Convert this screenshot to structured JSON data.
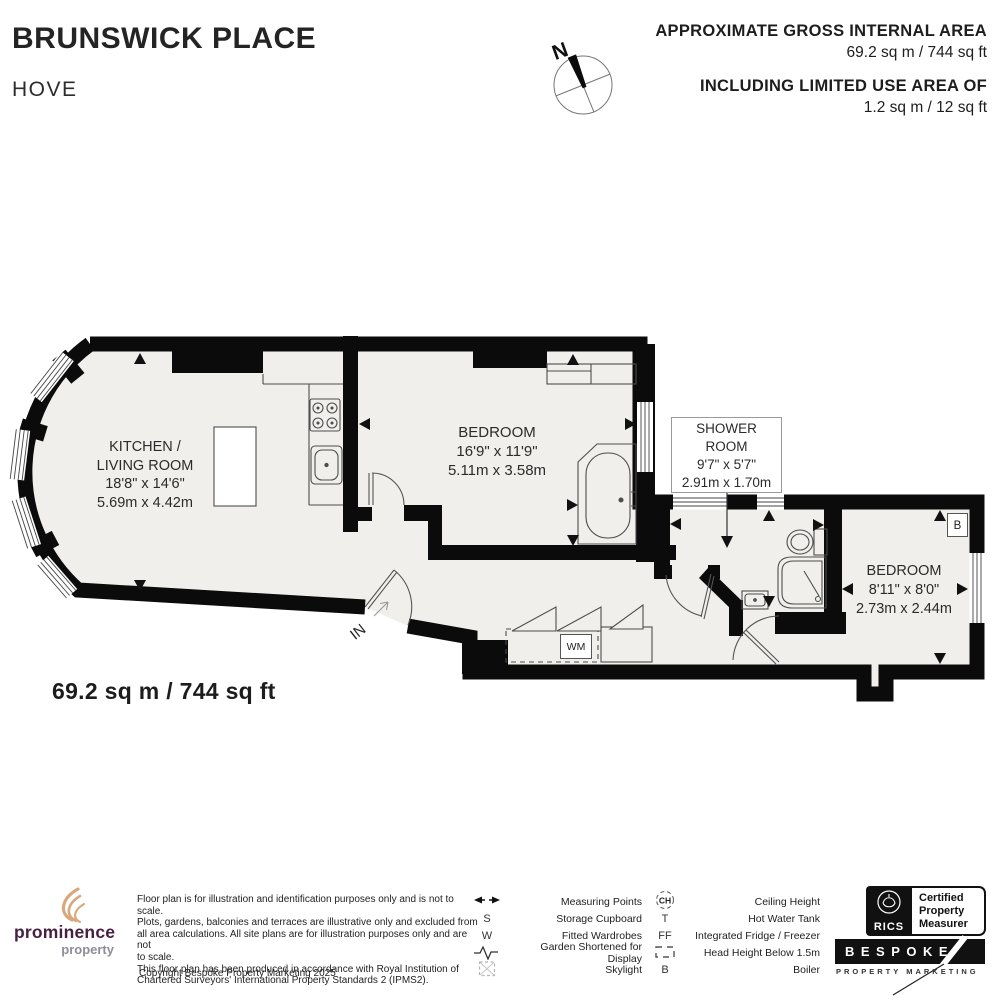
{
  "header": {
    "title": "BRUNSWICK PLACE",
    "subtitle": "HOVE",
    "gia_label": "APPROXIMATE GROSS INTERNAL AREA",
    "gia_value": "69.2 sq m / 744 sq ft",
    "limited_label": "INCLUDING LIMITED USE AREA OF",
    "limited_value": "1.2 sq m / 12 sq ft",
    "compass_north": "N"
  },
  "plan": {
    "total_area": "69.2 sq m / 744 sq ft",
    "in_label": "IN",
    "wm_label": "WM",
    "boiler_label": "B",
    "rooms": {
      "kitchen": {
        "line1": "KITCHEN /",
        "line2": "LIVING ROOM",
        "imperial": "18'8\" x 14'6\"",
        "metric": "5.69m x 4.42m"
      },
      "bedroom1": {
        "name": "BEDROOM",
        "imperial": "16'9\" x 11'9\"",
        "metric": "5.11m x 3.58m"
      },
      "shower": {
        "line1": "SHOWER",
        "line2": "ROOM",
        "imperial": "9'7\" x 5'7\"",
        "metric": "2.91m x 1.70m"
      },
      "bedroom2": {
        "name": "BEDROOM",
        "imperial": "8'11\" x 8'0\"",
        "metric": "2.73m x 2.44m"
      }
    }
  },
  "footer": {
    "disclaimer": [
      "Floor plan is for illustration and identification purposes only and is not to scale.",
      "Plots, gardens, balconies and terraces are illustrative only and excluded from",
      "all area calculations. All site plans are for illustration purposes only and are not",
      "to scale.",
      "This floor plan has been produced in accordance with Royal Institution of",
      "Chartered Surveyors' International Property Standards 2 (IPMS2)."
    ],
    "copyright": "Copyright Bespoke Property Marketing 2025",
    "legend": {
      "sym": {
        "s": "S",
        "w": "W",
        "t": "T",
        "ff": "FF",
        "b": "B",
        "ch": "CH"
      },
      "col1": [
        {
          "label": "Measuring Points"
        },
        {
          "label": "Storage Cupboard"
        },
        {
          "label": "Fitted Wardrobes"
        },
        {
          "label": "Garden Shortened for Display"
        },
        {
          "label": "Skylight"
        }
      ],
      "col2": [
        {
          "label": "Ceiling Height"
        },
        {
          "label": "Hot Water Tank"
        },
        {
          "label": "Integrated Fridge / Freezer"
        },
        {
          "label": "Head Height Below 1.5m"
        },
        {
          "label": "Boiler"
        }
      ]
    },
    "logos": {
      "prominence": "prominence",
      "prominence_sub": "property",
      "rics": "RICS",
      "cert1": "Certified",
      "cert2": "Property",
      "cert3": "Measurer",
      "bespoke": "BESPOKE",
      "bespoke_sub": "PROPERTY MARKETING"
    }
  },
  "colors": {
    "wall": "#0b0b0b",
    "floor": "#f0efec",
    "prominence_purple": "#472142",
    "prominence_tan": "#d9a87c"
  }
}
